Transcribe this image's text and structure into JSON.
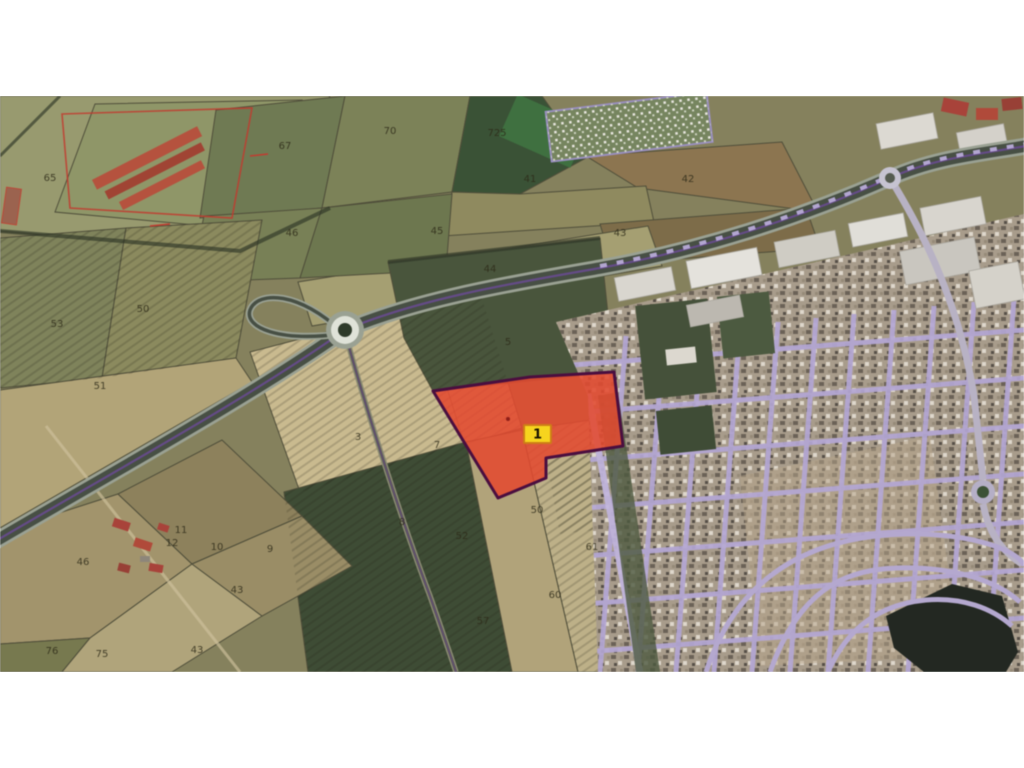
{
  "photo": {
    "description": "Aerial cadastral map photo with highlighted land plot, white frame above and below"
  },
  "map": {
    "highlighted_parcel": {
      "badge_label": "1",
      "fill": "#e24a30",
      "border": "#4a0e3f",
      "badge_bg": "#f6d41e",
      "badge_border": "#cd7d17"
    },
    "field_labels": [
      {
        "text": "65"
      },
      {
        "text": "67"
      },
      {
        "text": "70"
      },
      {
        "text": "725"
      },
      {
        "text": "41"
      },
      {
        "text": "42"
      },
      {
        "text": "46"
      },
      {
        "text": "45"
      },
      {
        "text": "43"
      },
      {
        "text": "44"
      },
      {
        "text": "53"
      },
      {
        "text": "50"
      },
      {
        "text": "51"
      },
      {
        "text": "5"
      },
      {
        "text": "3"
      },
      {
        "text": "7"
      },
      {
        "text": "8"
      },
      {
        "text": "50"
      },
      {
        "text": "52"
      },
      {
        "text": "61"
      },
      {
        "text": "60"
      },
      {
        "text": "57"
      },
      {
        "text": "46"
      },
      {
        "text": "10"
      },
      {
        "text": "9"
      },
      {
        "text": "11"
      },
      {
        "text": "12"
      },
      {
        "text": "43"
      },
      {
        "text": "76"
      },
      {
        "text": "75"
      },
      {
        "text": "43"
      }
    ],
    "colors": {
      "field_olive": "#7b7a57",
      "field_tan": "#b2a478",
      "field_dark_green": "#3e4c35",
      "field_pale": "#c9ba8f",
      "urban_street_lavender": "#b3a6d4",
      "road_asphalt": "#474f44",
      "cadastral_purple": "#6a4a93",
      "cadastral_red": "#c23b2f",
      "marina_water": "#232822"
    }
  }
}
